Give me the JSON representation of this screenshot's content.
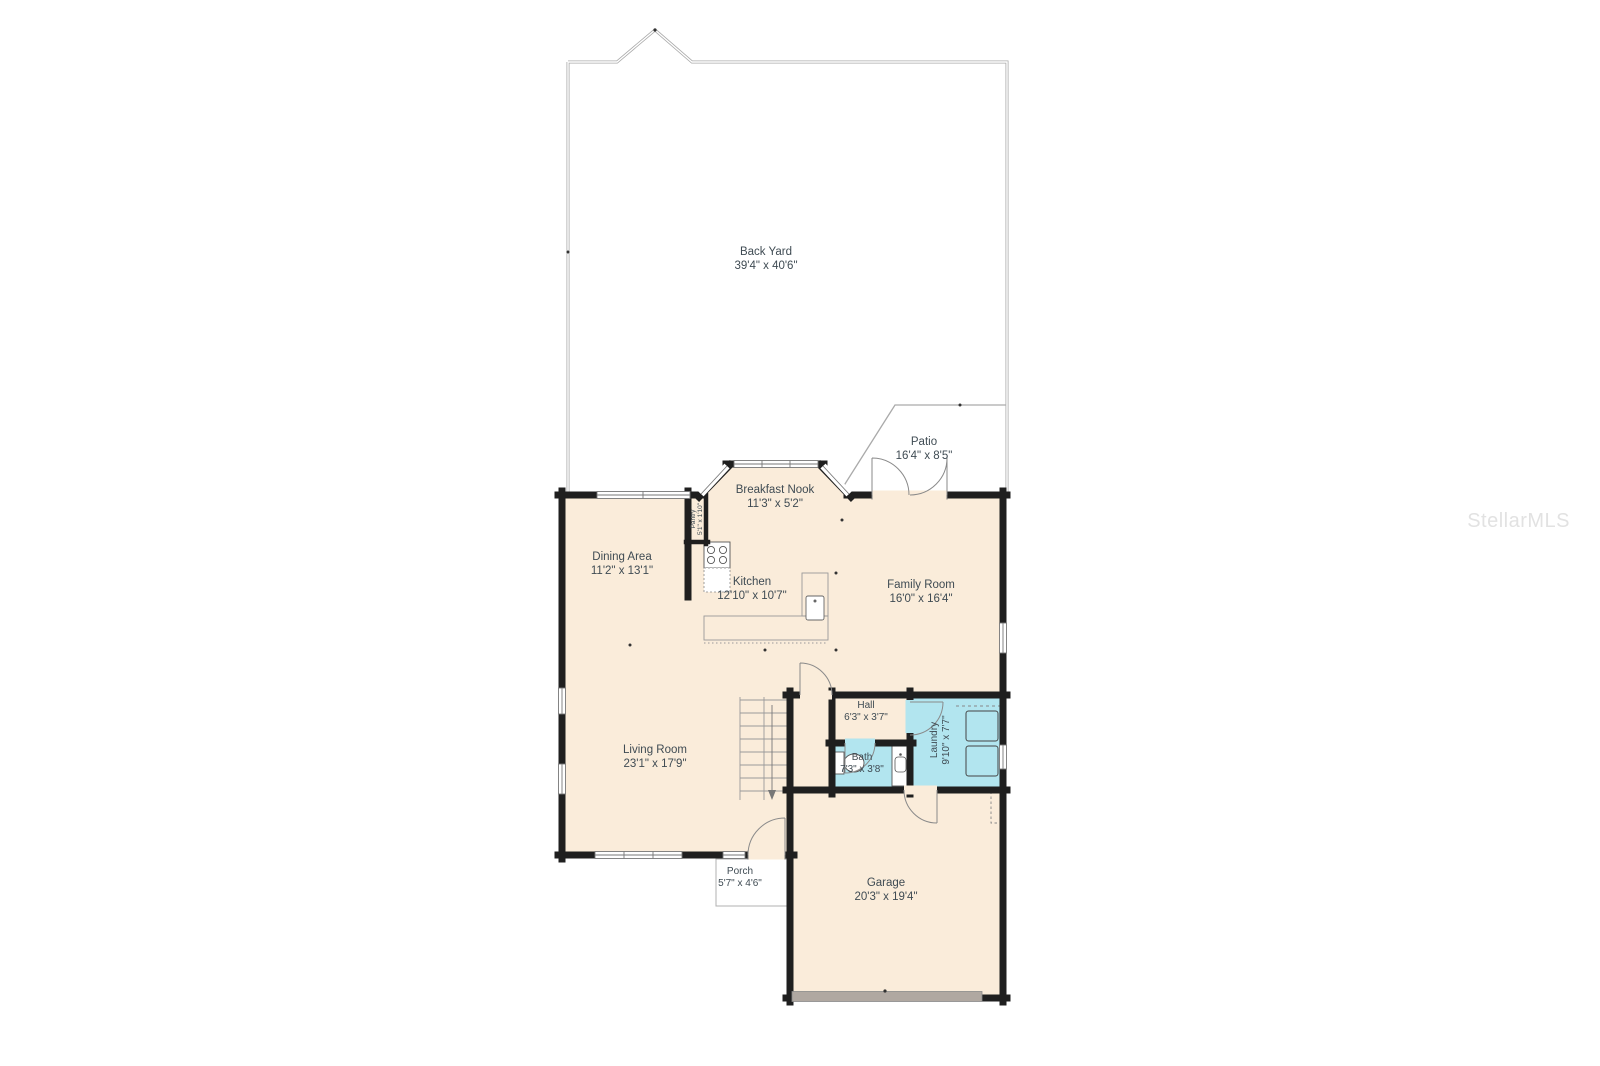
{
  "watermark": {
    "text": "StellarMLS"
  },
  "rooms": {
    "back_yard": {
      "name": "Back Yard",
      "dims": "39'4\" x 40'6\""
    },
    "patio": {
      "name": "Patio",
      "dims": "16'4\" x 8'5\""
    },
    "breakfast_nook": {
      "name": "Breakfast Nook",
      "dims": "11'3\" x 5'2\""
    },
    "pantry": {
      "name": "Pantry",
      "dims": "5'1\" x 1'10\""
    },
    "dining_area": {
      "name": "Dining Area",
      "dims": "11'2\" x 13'1\""
    },
    "kitchen": {
      "name": "Kitchen",
      "dims": "12'10\" x 10'7\""
    },
    "family_room": {
      "name": "Family Room",
      "dims": "16'0\" x 16'4\""
    },
    "hall": {
      "name": "Hall",
      "dims": "6'3\" x 3'7\""
    },
    "laundry": {
      "name": "Laundry",
      "dims": "9'10\" x 7'7\""
    },
    "bath": {
      "name": "Bath",
      "dims": "7'3\" x 3'8\""
    },
    "living_room": {
      "name": "Living Room",
      "dims": "23'1\" x 17'9\""
    },
    "porch": {
      "name": "Porch",
      "dims": "5'7\" x 4'6\""
    },
    "garage": {
      "name": "Garage",
      "dims": "20'3\" x 19'4\""
    }
  },
  "colors": {
    "floor": "#faecda",
    "wet_room": "#b2e5ef",
    "wall": "#1f1f1f",
    "thin_line": "#8a8a8a",
    "fence": "#b3b3b3",
    "label_text": "#3f4b53",
    "garage_door": "#b0a8a1",
    "watermark": "#e2e2e2"
  },
  "fixtures": [
    "stove-icon",
    "counter",
    "sink-icon",
    "toilet-icon",
    "vanity-icon",
    "washer-icon",
    "dryer-icon",
    "stairs",
    "french-doors",
    "garage-door"
  ]
}
